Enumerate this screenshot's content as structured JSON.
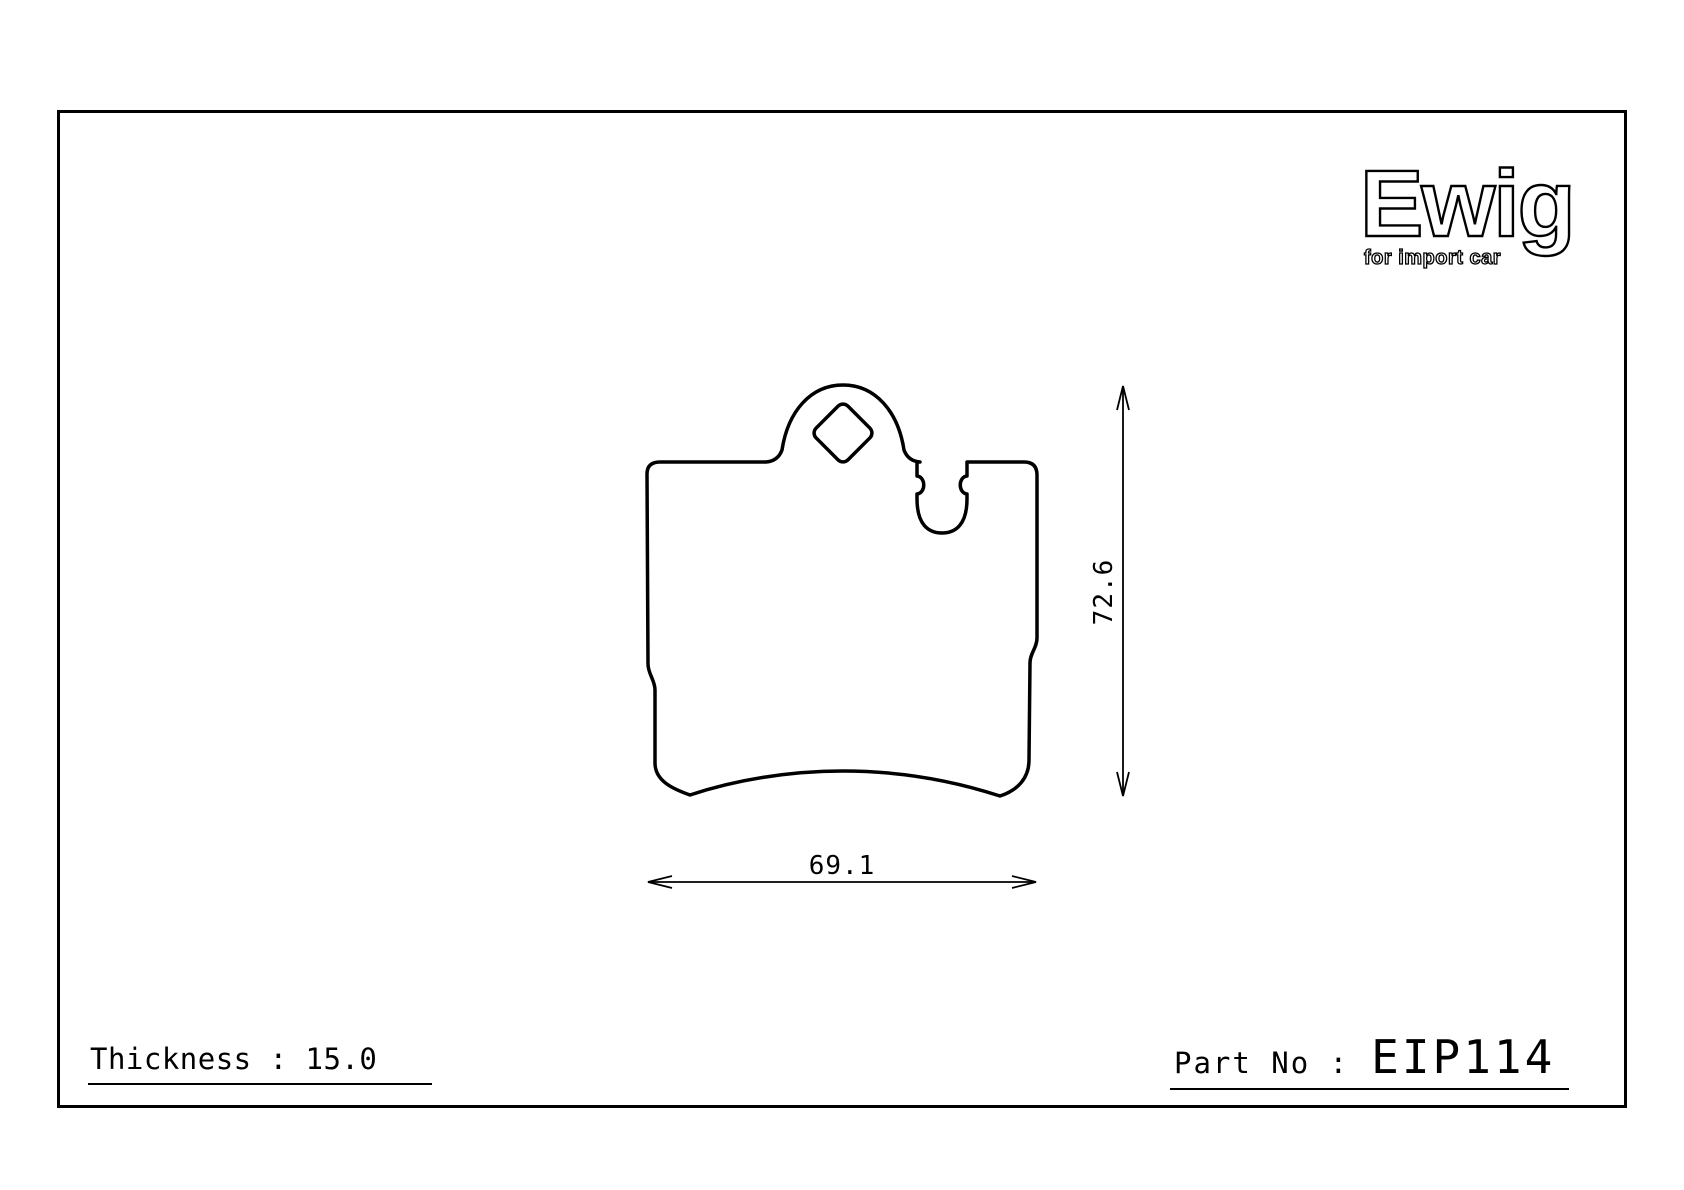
{
  "sheet": {
    "background_color": "#ffffff",
    "line_color": "#000000"
  },
  "logo": {
    "brand": "Ewig",
    "tagline": "for import car"
  },
  "drawing": {
    "type": "brake-pad-technical-drawing",
    "height_dim_label": "72.6",
    "width_dim_label": "69.1"
  },
  "footer": {
    "thickness_text": "Thickness : 15.0",
    "part_no_label": "Part No :",
    "part_no_value": "EIP114"
  }
}
